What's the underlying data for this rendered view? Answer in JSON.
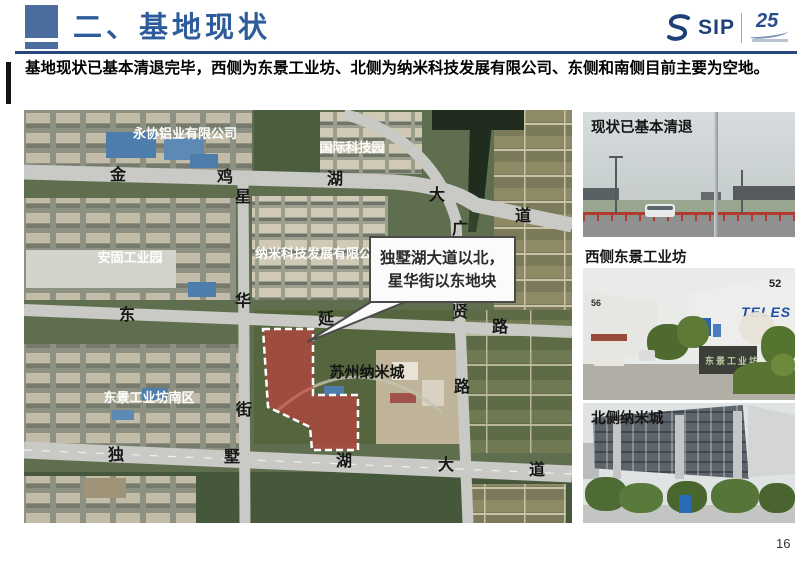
{
  "page_number": "16",
  "header": {
    "title": "二、基地现状",
    "logo": {
      "sip": "SIP",
      "anniversary": "25"
    }
  },
  "banner": {
    "text": "基地现状已基本清退完毕，西侧为东景工业坊、北侧为纳米科技发展有限公司、东侧和南侧目前主要为空地。"
  },
  "map": {
    "area_labels": [
      {
        "text": "永协铝业有限公司"
      },
      {
        "text": "国际科技园"
      },
      {
        "text": "安固工业园"
      },
      {
        "text": "纳米科技发展有限公司"
      },
      {
        "text": "苏州纳米城"
      },
      {
        "text": "东景工业坊南区"
      }
    ],
    "road_labels": [
      "金",
      "鸡",
      "湖",
      "大",
      "道",
      "星",
      "华",
      "街",
      "东",
      "延",
      "路",
      "广",
      "贤",
      "路",
      "独",
      "墅",
      "湖",
      "大",
      "道"
    ],
    "callout": {
      "line1": "独墅湖大道以北，",
      "line2": "星华街以东地块"
    }
  },
  "photos": [
    {
      "caption": "现状已基本清退"
    },
    {
      "caption": "西侧东景工业坊",
      "signs": [
        "56",
        "52",
        "TELES",
        "东景工业坊"
      ]
    },
    {
      "caption": "北侧纳米城"
    }
  ],
  "colors": {
    "title_blue": "#2e5c9a",
    "header_rule_blue": "#27477e",
    "accent_square_blue": "#4a6d9e",
    "site_red": "#c93b3b",
    "logo_navy": "#1d4076"
  }
}
